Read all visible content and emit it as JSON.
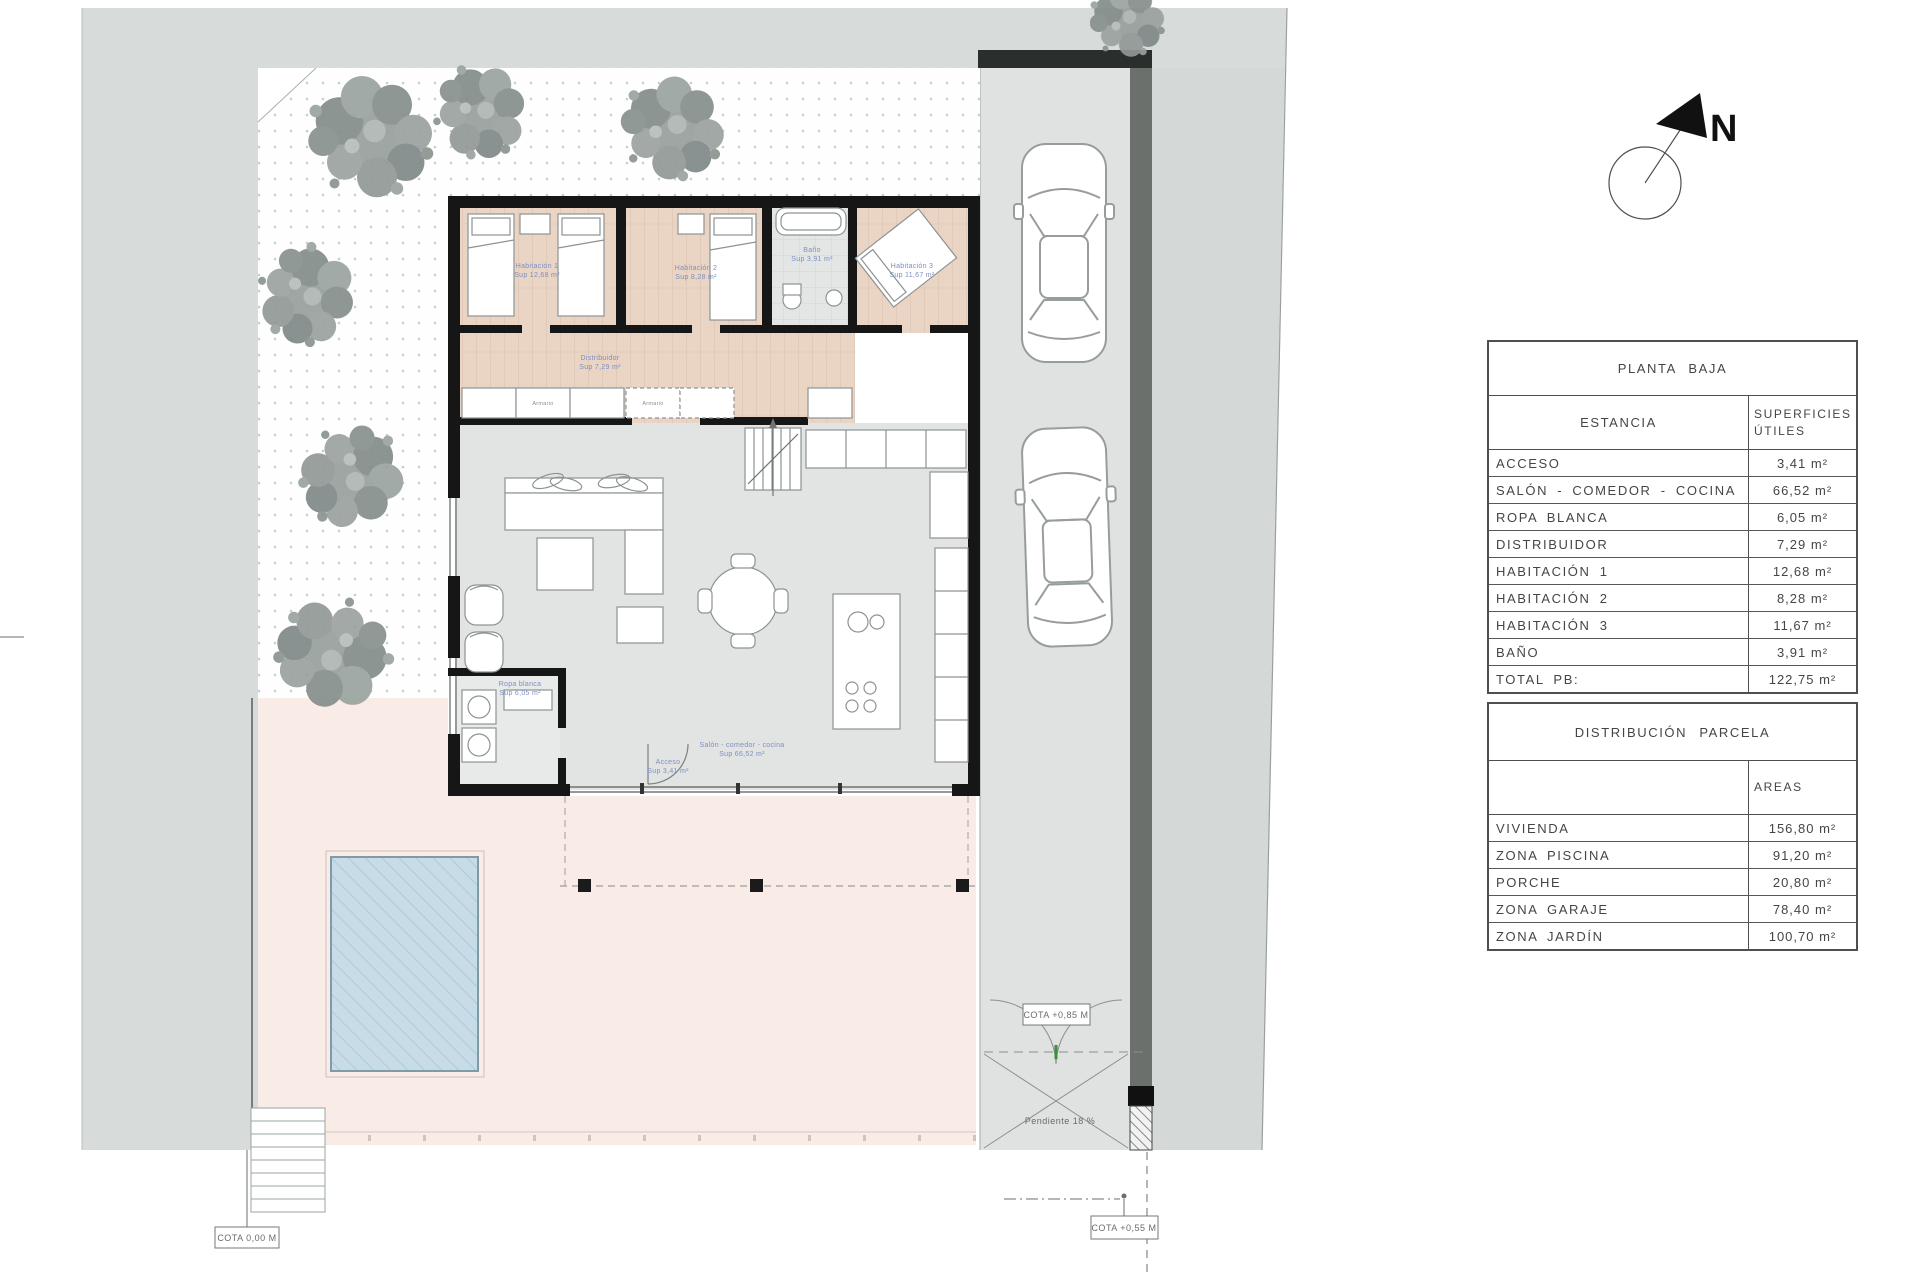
{
  "sheet": {
    "north_label": "N",
    "annotations": {
      "cota_ground": "COTA 0,00 M",
      "cota_mid": "COTA +0,55 M",
      "cota_gate": "COTA +0,85 M",
      "slope": "Pendiente 18 %"
    },
    "room_labels": {
      "hab1_name": "Habitación 1",
      "hab1_area": "Sup 12,68 m²",
      "hab2_name": "Habitación 2",
      "hab2_area": "Sup 8,28 m²",
      "hab3_name": "Habitación 3",
      "hab3_area": "Sup 11,67 m²",
      "bano_name": "Baño",
      "bano_area": "Sup 3,91 m²",
      "distribuidor_name": "Distribuidor",
      "distribuidor_area": "Sup 7,29 m²",
      "salon_name": "Salón - comedor - cocina",
      "salon_area": "Sup 66,52 m²",
      "acceso_name": "Acceso",
      "acceso_area": "Sup 3,41 m²",
      "ropa_name": "Ropa blanca",
      "ropa_area": "Sup 6,05 m²",
      "armario": "Armario"
    }
  },
  "tables": {
    "pb": {
      "title": "PLANTA BAJA",
      "col_estancia": "ESTANCIA",
      "col_superficies_line1": "SUPERFICIES",
      "col_superficies_line2": "ÚTILES",
      "rows": [
        {
          "name": "ACCESO",
          "value": "3,41 m²"
        },
        {
          "name": "SALÓN - COMEDOR - COCINA",
          "value": "66,52 m²"
        },
        {
          "name": "ROPA BLANCA",
          "value": "6,05 m²"
        },
        {
          "name": "DISTRIBUIDOR",
          "value": "7,29 m²"
        },
        {
          "name": "HABITACIÓN 1",
          "value": "12,68 m²"
        },
        {
          "name": "HABITACIÓN 2",
          "value": "8,28 m²"
        },
        {
          "name": "HABITACIÓN 3",
          "value": "11,67 m²"
        },
        {
          "name": "BAÑO",
          "value": "3,91 m²"
        },
        {
          "name": "TOTAL PB:",
          "value": "122,75 m²"
        }
      ]
    },
    "parcela": {
      "title": "DISTRIBUCIÓN PARCELA",
      "col_areas": "AREAS",
      "rows": [
        {
          "name": "VIVIENDA",
          "value": "156,80 m²"
        },
        {
          "name": "ZONA PISCINA",
          "value": "91,20 m²"
        },
        {
          "name": "PORCHE",
          "value": "20,80 m²"
        },
        {
          "name": "ZONA GARAJE",
          "value": "78,40 m²"
        },
        {
          "name": "ZONA JARDÍN",
          "value": "100,70 m²"
        }
      ]
    }
  }
}
